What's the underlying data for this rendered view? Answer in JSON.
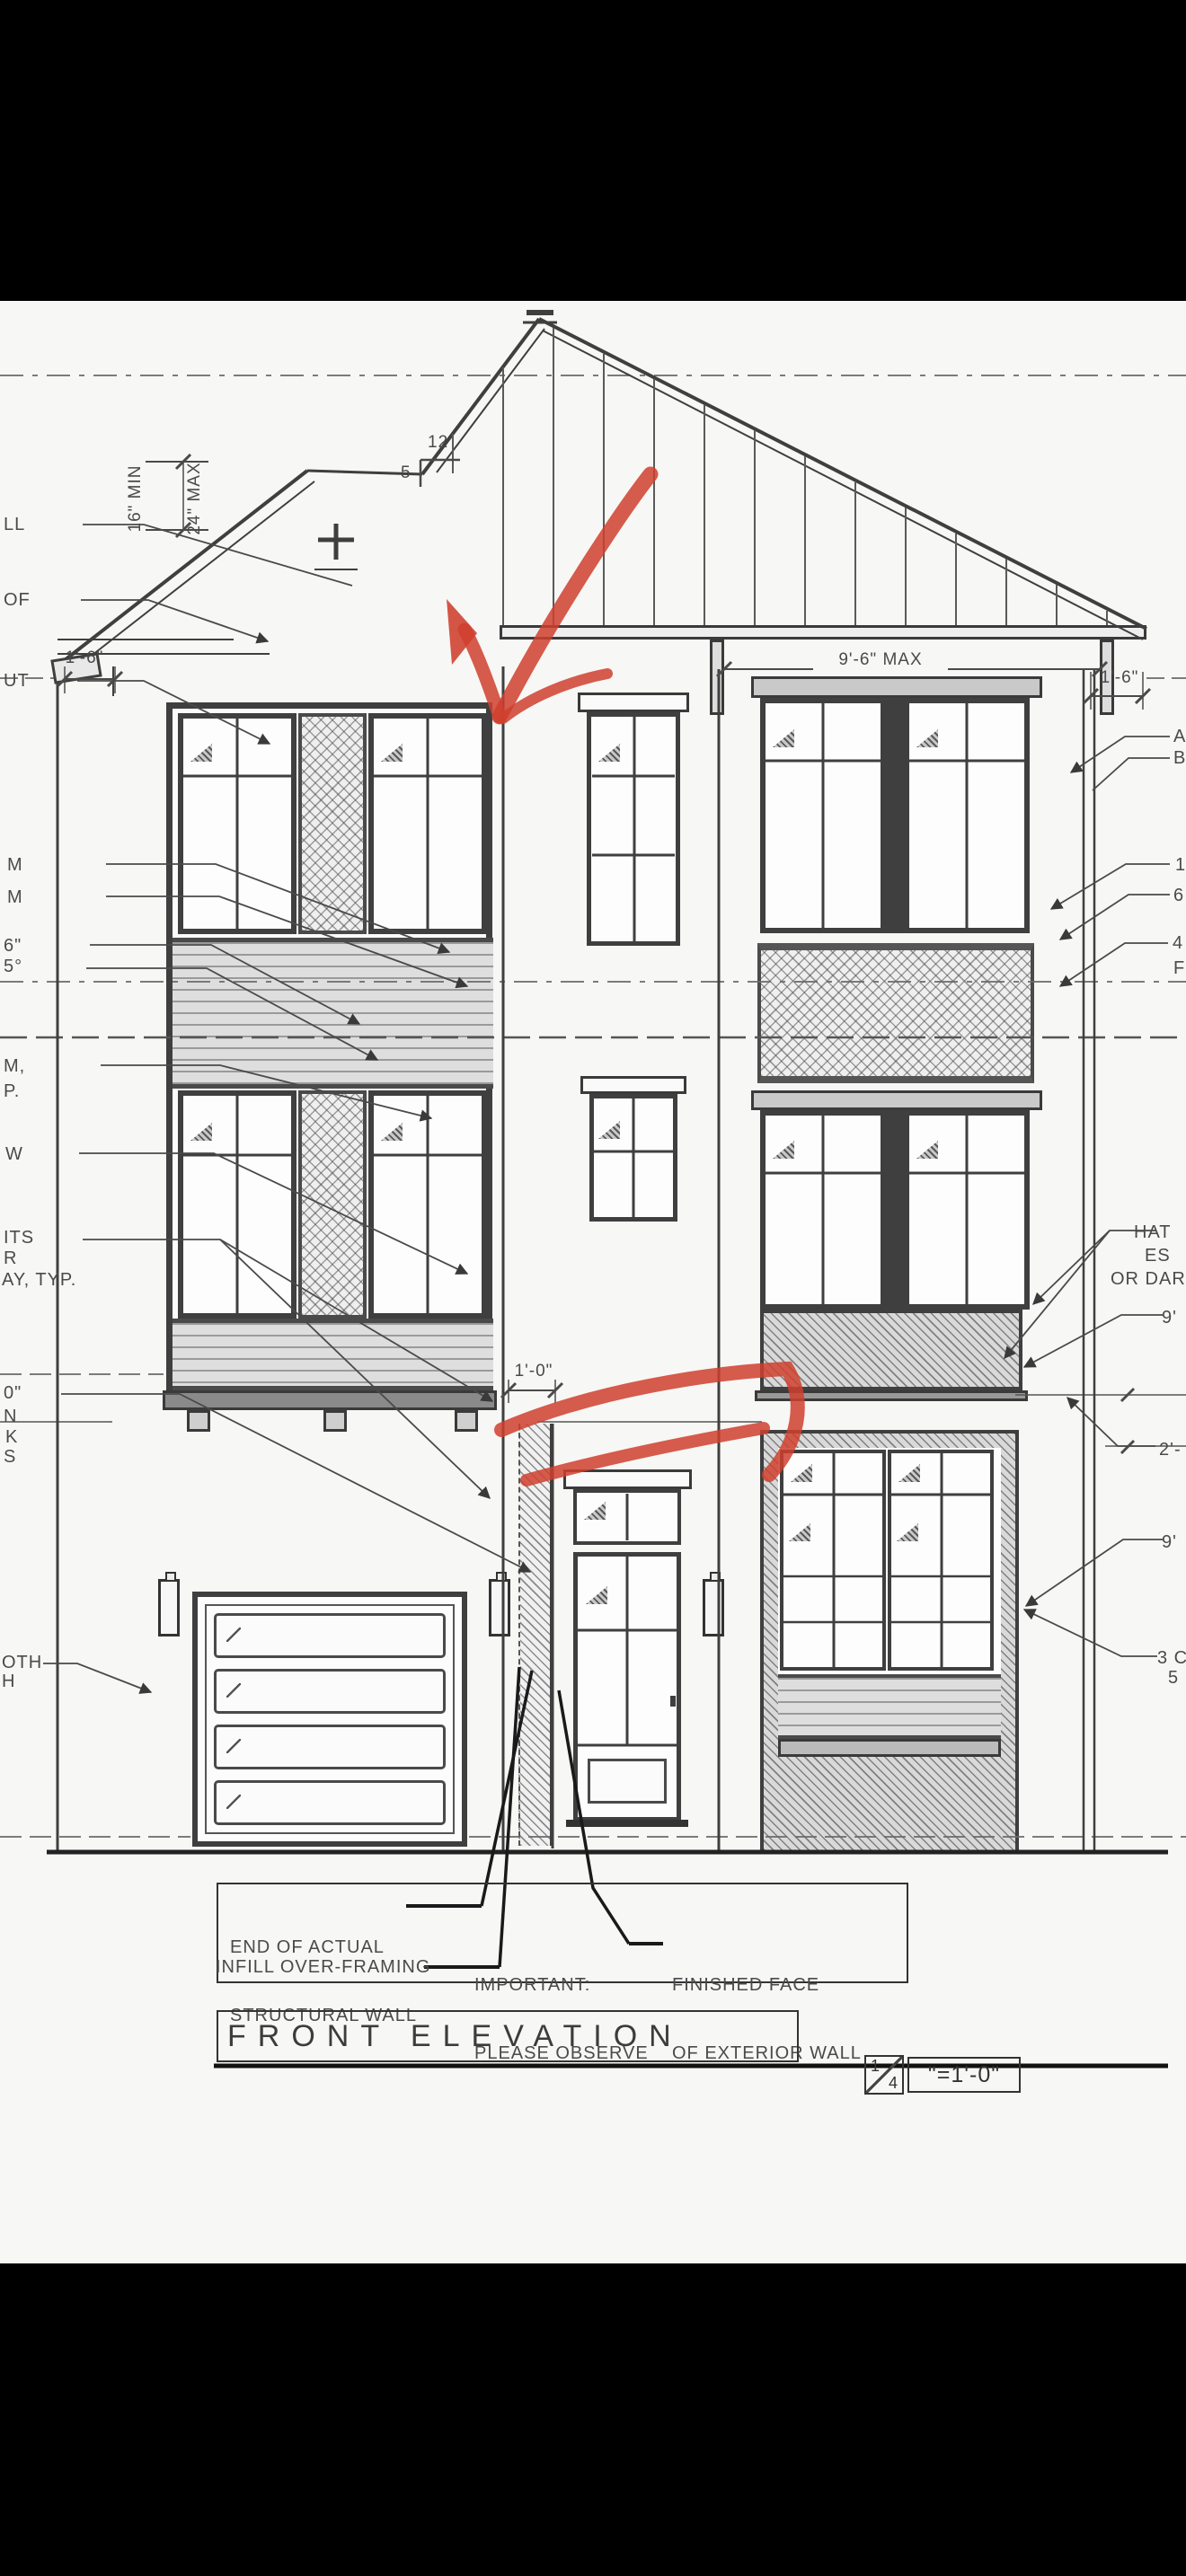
{
  "labels": {
    "left": [
      {
        "t": "LL"
      },
      {
        "t": "OF"
      },
      {
        "t": "UT"
      },
      {
        "t": "M"
      },
      {
        "t": "M"
      },
      {
        "t": "6\""
      },
      {
        "t": "5°"
      },
      {
        "t": "M,"
      },
      {
        "t": "P."
      },
      {
        "t": "W"
      },
      {
        "t": "ITS"
      },
      {
        "t": "R"
      },
      {
        "t": "AY, TYP."
      },
      {
        "t": "0\""
      },
      {
        "t": "N"
      },
      {
        "t": "K"
      },
      {
        "t": "S"
      },
      {
        "t": "OTH"
      },
      {
        "t": "H"
      }
    ],
    "right": [
      {
        "t": "A"
      },
      {
        "t": "B"
      },
      {
        "t": "1"
      },
      {
        "t": "6"
      },
      {
        "t": "4"
      },
      {
        "t": "F"
      },
      {
        "t": "HAT"
      },
      {
        "t": "ES"
      },
      {
        "t": "OR DARK"
      },
      {
        "t": "9'"
      },
      {
        "t": "2'-"
      },
      {
        "t": "9'"
      },
      {
        "t": "3 C"
      },
      {
        "t": "5"
      }
    ]
  },
  "dims": {
    "overhang_min": "16\" MIN",
    "overhang_max": "24\" MAX",
    "left_overhang": "1'-6\"",
    "right_overhang": "1'-6\"",
    "plate_max": "9'-6\" MAX",
    "infill_width": "1'-0\""
  },
  "roof_slope": {
    "run": "12",
    "rise": "5"
  },
  "callouts": {
    "end_line1": "END OF ACTUAL",
    "end_line2": "STRUCTURAL WALL",
    "infill": "INFILL OVER-FRAMING",
    "important_line1": "IMPORTANT:",
    "important_line2": "PLEASE OBSERVE",
    "finished_line1": "FINISHED FACE",
    "finished_line2": "OF EXTERIOR WALL"
  },
  "title_block": {
    "title": "FRONT ELEVATION",
    "scale_numerator": "1",
    "scale_denominator": "4",
    "scale_text": "\"=1'-0\""
  },
  "colors": {
    "marker_red": "#cf3f2e",
    "line_dark": "#3f3f3f",
    "paper": "#f7f7f5"
  }
}
